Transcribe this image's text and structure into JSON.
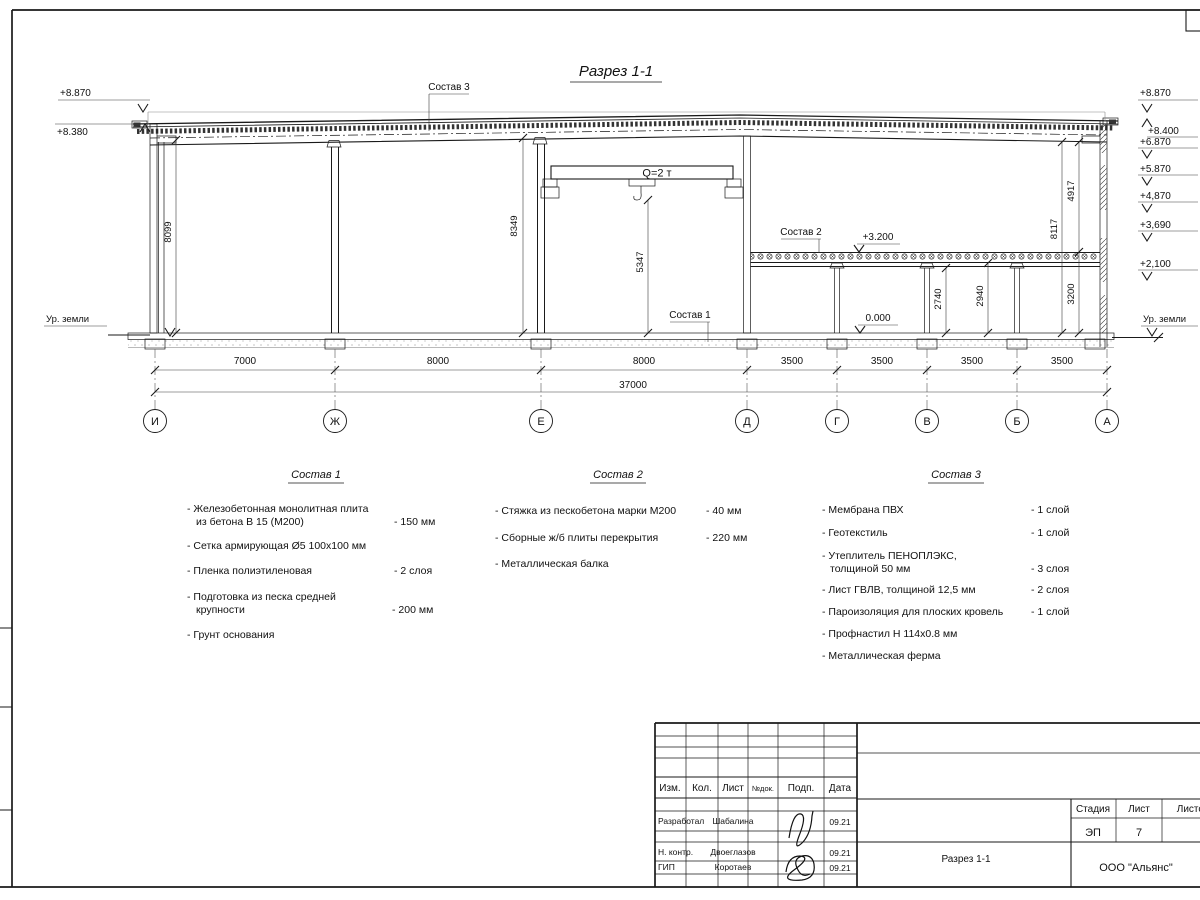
{
  "page": {
    "title": "Разрез 1-1"
  },
  "marks": {
    "left": {
      "top": "+8.870",
      "eaves": "+8.380",
      "ground": "Ур. земли"
    },
    "right": {
      "top": "+8.870",
      "levels": [
        "+8.400",
        "+6.870",
        "+5.870",
        "+4,870",
        "+3,690",
        "+2,100"
      ],
      "ground": "Ур. земли"
    },
    "mezzanine": "+3.200",
    "floor_zero": "0.000"
  },
  "crane": {
    "label": "Q=2 т"
  },
  "refs": {
    "s1": "Состав 1",
    "s2": "Состав 2",
    "s3": "Состав 3"
  },
  "dims": {
    "heights": {
      "h8099": "8099",
      "h8349": "8349",
      "h5347": "5347",
      "h2740": "2740",
      "h2940": "2940",
      "h3200": "3200",
      "h8117": "8117",
      "h4917": "4917"
    },
    "spans": [
      "7000",
      "8000",
      "8000",
      "3500",
      "3500",
      "3500",
      "3500"
    ],
    "total": "37000"
  },
  "axes": [
    "И",
    "Ж",
    "Е",
    "Д",
    "Г",
    "В",
    "Б",
    "А"
  ],
  "lists": {
    "s1": {
      "title": "Состав 1",
      "items": [
        {
          "l1": "- Железобетонная  монолитная плита",
          "l2": "из бетона В 15 (М200)",
          "val": "- 150 мм"
        },
        {
          "l1": "- Сетка армирующая Ø5 100х100 мм",
          "l2": "",
          "val": ""
        },
        {
          "l1": "- Пленка полиэтиленовая",
          "l2": "",
          "val": "-  2 слоя"
        },
        {
          "l1": "- Подготовка из песка средней",
          "l2": "крупности",
          "val": "- 200 мм"
        },
        {
          "l1": "- Грунт основания",
          "l2": "",
          "val": ""
        }
      ]
    },
    "s2": {
      "title": "Состав 2",
      "items": [
        {
          "l1": "- Стяжка из пескобетона марки М200",
          "val": "- 40 мм"
        },
        {
          "l1": "- Сборные ж/б плиты перекрытия",
          "val": "- 220 мм"
        },
        {
          "l1": "- Металлическая балка",
          "val": ""
        }
      ]
    },
    "s3": {
      "title": "Состав 3",
      "items": [
        {
          "l1": "- Мембрана ПВХ",
          "l2": "",
          "val": "- 1 слой"
        },
        {
          "l1": "- Геотекстиль",
          "l2": "",
          "val": "- 1 слой"
        },
        {
          "l1": "- Утеплитель ПЕНОПЛЭКС,",
          "l2": "толщиной 50 мм",
          "val": "- 3 слоя"
        },
        {
          "l1": "- Лист ГВЛВ, толщиной 12,5 мм",
          "l2": "",
          "val": "- 2 слоя"
        },
        {
          "l1": "- Пароизоляция для плоских кровель",
          "l2": "",
          "val": "- 1 слой"
        },
        {
          "l1": "- Профнастил Н 114х0.8 мм",
          "l2": "",
          "val": ""
        },
        {
          "l1": "- Металлическая ферма",
          "l2": "",
          "val": ""
        }
      ]
    }
  },
  "titleblock": {
    "cols": {
      "izm": "Изм.",
      "kol": "Кол.",
      "list": "Лист",
      "ndok": "№док.",
      "podp": "Подп.",
      "data": "Дата"
    },
    "rows": [
      {
        "role": "Разработал",
        "name": "Шабалина",
        "date": "09.21"
      },
      {
        "role": "Н. контр.",
        "name": "Двоеглазов",
        "date": "09.21"
      },
      {
        "role": "ГИП",
        "name": "Коротаев",
        "date": "09.21"
      }
    ],
    "stage_label": "Стадия",
    "sheet_label": "Лист",
    "sheets_label": "Листов",
    "stage": "ЭП",
    "sheet_no": "7",
    "sheets": "",
    "doc_name": "Разрез 1-1",
    "company": "ООО \"Альянс\""
  }
}
